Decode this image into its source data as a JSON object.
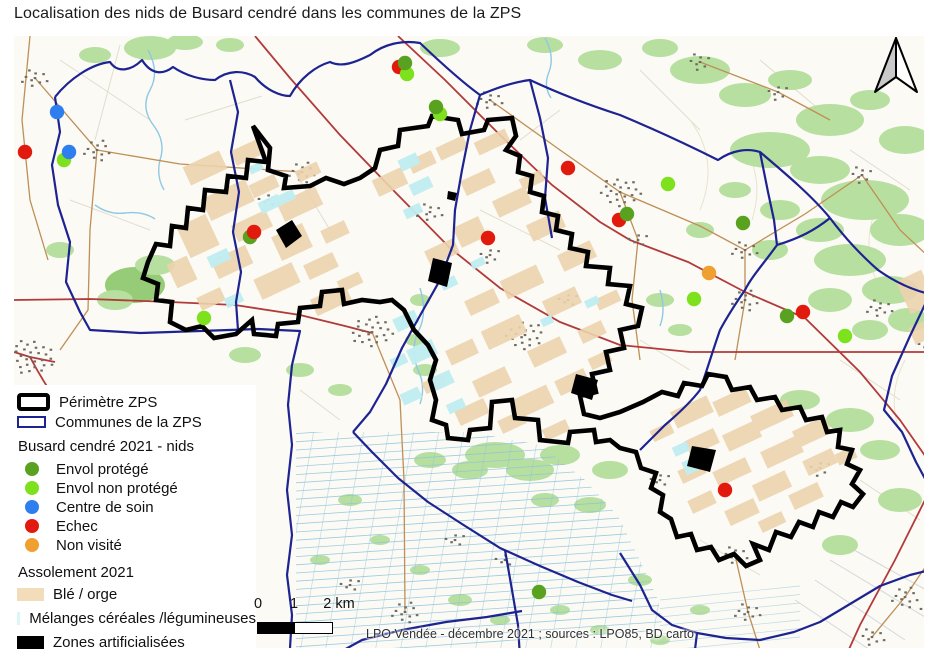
{
  "title": "Localisation des nids de Busard cendré dans les communes de la ZPS",
  "legend": {
    "perimetre": {
      "label": "Périmètre ZPS",
      "color": "#000000"
    },
    "communes": {
      "label": "Communes de la ZPS",
      "color": "#1d2390"
    },
    "nids_heading": "Busard cendré 2021 - nids",
    "nest_statuses": [
      {
        "id": "envol_protege",
        "label": "Envol protégé",
        "color": "#58a21f"
      },
      {
        "id": "envol_non_protege",
        "label": "Envol non protégé",
        "color": "#7de11e"
      },
      {
        "id": "centre_de_soin",
        "label": "Centre de soin",
        "color": "#2e7ef0"
      },
      {
        "id": "echec",
        "label": "Echec",
        "color": "#e2190d"
      },
      {
        "id": "non_visite",
        "label": "Non visité",
        "color": "#f0a030"
      }
    ],
    "assolement_heading": "Assolement 2021",
    "assolement": [
      {
        "id": "ble_orge",
        "label": "Blé / orge",
        "color": "#f2dcba"
      },
      {
        "id": "melanges",
        "label": "Mélanges céréales /légumineuses",
        "color": "#dcf5f7"
      },
      {
        "id": "zones_artificialisees",
        "label": "Zones artificialisées",
        "color": "#000000"
      }
    ]
  },
  "scalebar": {
    "ticks": [
      "0",
      "1",
      "2 km"
    ]
  },
  "attribution": "LPO Vendée - décembre 2021 ; sources : LPO85, BD carto",
  "nests": [
    {
      "x": 64,
      "y": 160,
      "status": "envol_non_protege"
    },
    {
      "x": 69,
      "y": 152,
      "status": "centre_de_soin"
    },
    {
      "x": 57,
      "y": 112,
      "status": "centre_de_soin"
    },
    {
      "x": 25,
      "y": 152,
      "status": "echec"
    },
    {
      "x": 399,
      "y": 67,
      "status": "echec"
    },
    {
      "x": 407,
      "y": 74,
      "status": "envol_non_protege"
    },
    {
      "x": 405,
      "y": 63,
      "status": "envol_protege"
    },
    {
      "x": 440,
      "y": 114,
      "status": "envol_non_protege"
    },
    {
      "x": 436,
      "y": 107,
      "status": "envol_protege"
    },
    {
      "x": 250,
      "y": 237,
      "status": "envol_protege"
    },
    {
      "x": 254,
      "y": 232,
      "status": "echec"
    },
    {
      "x": 204,
      "y": 318,
      "status": "envol_non_protege"
    },
    {
      "x": 488,
      "y": 238,
      "status": "echec"
    },
    {
      "x": 568,
      "y": 168,
      "status": "echec"
    },
    {
      "x": 619,
      "y": 220,
      "status": "echec"
    },
    {
      "x": 627,
      "y": 214,
      "status": "envol_protege"
    },
    {
      "x": 668,
      "y": 184,
      "status": "envol_non_protege"
    },
    {
      "x": 743,
      "y": 223,
      "status": "envol_protege"
    },
    {
      "x": 709,
      "y": 273,
      "status": "non_visite"
    },
    {
      "x": 694,
      "y": 299,
      "status": "envol_non_protege"
    },
    {
      "x": 787,
      "y": 316,
      "status": "envol_protege"
    },
    {
      "x": 803,
      "y": 312,
      "status": "echec"
    },
    {
      "x": 845,
      "y": 336,
      "status": "envol_non_protege"
    },
    {
      "x": 725,
      "y": 490,
      "status": "echec"
    },
    {
      "x": 539,
      "y": 592,
      "status": "envol_protege"
    }
  ]
}
